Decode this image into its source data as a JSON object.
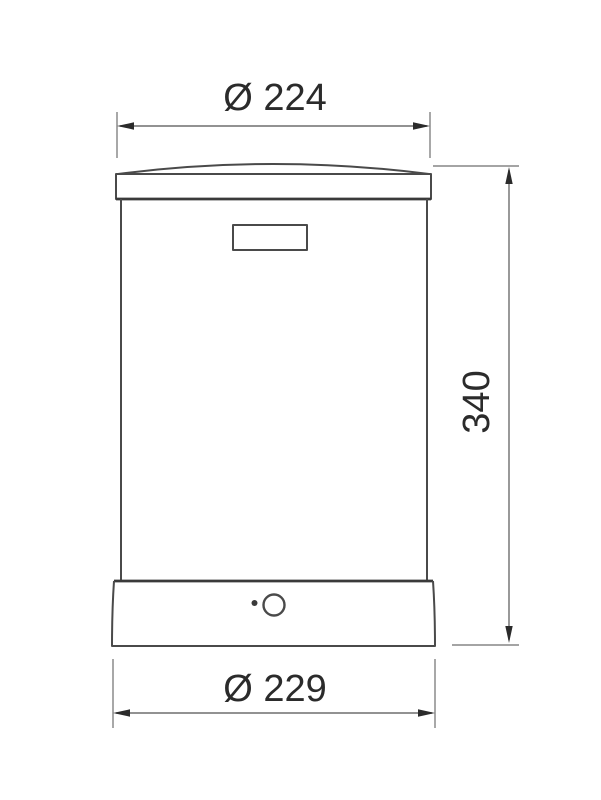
{
  "drawing": {
    "dimensions": {
      "top_diameter": {
        "label": "Ø 224",
        "value": 224
      },
      "height": {
        "label": "340",
        "value": 340
      },
      "bottom_diameter": {
        "label": "Ø 229",
        "value": 229
      }
    }
  },
  "colors": {
    "background": "#ffffff",
    "outline": "#4a4a4a",
    "outline-dark": "#3a3a3a",
    "dim-line": "#6e6e6e",
    "dim-text": "#2b2b2b"
  }
}
